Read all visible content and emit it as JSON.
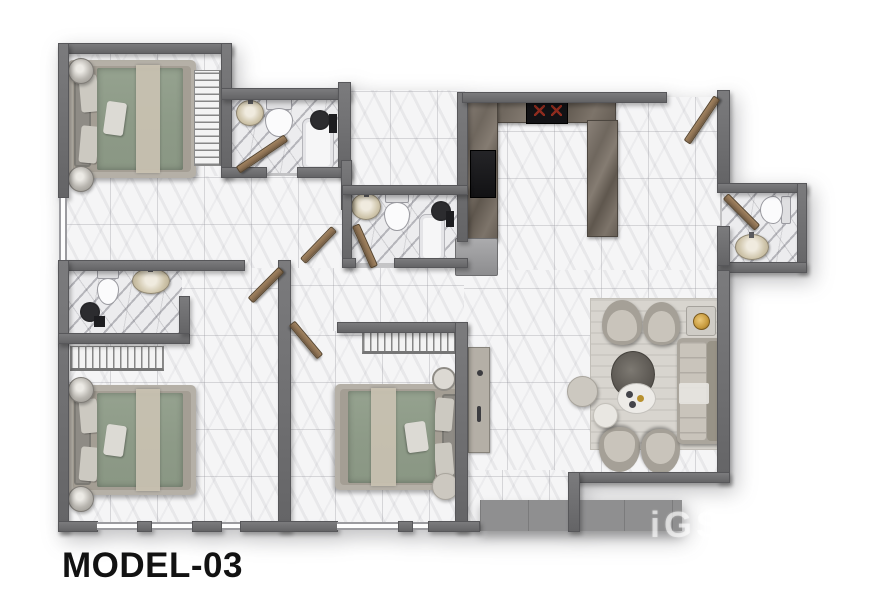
{
  "title": {
    "label": "MODEL-03"
  },
  "watermark": {
    "text": "iGS"
  },
  "colors": {
    "wall": "#6f6f71",
    "wall_dark": "#57575a",
    "floor": "#f5f5f6",
    "duvet": "#8d9a87",
    "frame": "#b5b0a7",
    "upholstery": "#c9c4bb",
    "wood": "#8a6f52",
    "gold": "#c79a3d",
    "slab": "#8f8f90",
    "title": "#121212"
  },
  "plan": {
    "canvas": {
      "w": 890,
      "h": 594
    },
    "floors": [
      {
        "name": "floor-bedroom-1",
        "kind": "fl-tile",
        "rect": [
          63,
          48,
          164,
          130
        ]
      },
      {
        "name": "floor-bathroom-1",
        "kind": "fl-marble",
        "rect": [
          227,
          93,
          116,
          80
        ]
      },
      {
        "name": "floor-entry-hall",
        "kind": "fl-tile",
        "rect": [
          343,
          90,
          122,
          96
        ]
      },
      {
        "name": "floor-kitchen",
        "kind": "fl-tile",
        "rect": [
          460,
          97,
          260,
          176
        ]
      },
      {
        "name": "floor-wc",
        "kind": "fl-marble",
        "rect": [
          722,
          188,
          80,
          79
        ]
      },
      {
        "name": "floor-living",
        "kind": "fl-tile",
        "rect": [
          460,
          270,
          260,
          207
        ]
      },
      {
        "name": "floor-hall",
        "kind": "fl-tile",
        "rect": [
          63,
          176,
          284,
          96
        ]
      },
      {
        "name": "floor-bathroom-2",
        "kind": "fl-marble",
        "rect": [
          347,
          190,
          115,
          73
        ]
      },
      {
        "name": "floor-corridor",
        "kind": "fl-tile",
        "rect": [
          286,
          268,
          178,
          65
        ]
      },
      {
        "name": "floor-bedroom-2",
        "kind": "fl-tile",
        "rect": [
          63,
          268,
          218,
          256
        ]
      },
      {
        "name": "floor-bathroom-3",
        "kind": "fl-marble",
        "rect": [
          67,
          268,
          115,
          68
        ]
      },
      {
        "name": "floor-bedroom-3",
        "kind": "fl-tile",
        "rect": [
          288,
          331,
          170,
          193
        ]
      },
      {
        "name": "floor-corridor-south",
        "kind": "fl-tile",
        "rect": [
          455,
          470,
          115,
          54
        ]
      }
    ],
    "walls": [
      [
        58,
        43,
        174,
        11
      ],
      [
        58,
        43,
        11,
        155
      ],
      [
        221,
        43,
        11,
        135
      ],
      [
        221,
        88,
        130,
        12
      ],
      [
        338,
        82,
        13,
        96
      ],
      [
        221,
        167,
        46,
        11
      ],
      [
        297,
        167,
        54,
        11
      ],
      [
        457,
        92,
        11,
        150
      ],
      [
        462,
        92,
        205,
        11
      ],
      [
        717,
        90,
        13,
        95
      ],
      [
        717,
        183,
        90,
        10
      ],
      [
        797,
        183,
        10,
        89
      ],
      [
        717,
        262,
        90,
        11
      ],
      [
        717,
        226,
        13,
        40
      ],
      [
        717,
        270,
        13,
        213
      ],
      [
        568,
        472,
        162,
        11
      ],
      [
        568,
        472,
        12,
        60
      ],
      [
        341,
        160,
        11,
        50
      ],
      [
        342,
        185,
        10,
        83
      ],
      [
        342,
        185,
        126,
        10
      ],
      [
        342,
        258,
        14,
        10
      ],
      [
        394,
        258,
        74,
        10
      ],
      [
        58,
        260,
        187,
        11
      ],
      [
        58,
        260,
        11,
        272
      ],
      [
        58,
        333,
        132,
        11
      ],
      [
        179,
        296,
        11,
        38
      ],
      [
        278,
        260,
        13,
        272
      ],
      [
        337,
        322,
        131,
        11
      ],
      [
        455,
        322,
        13,
        210
      ],
      [
        58,
        521,
        40,
        11
      ],
      [
        137,
        521,
        15,
        11
      ],
      [
        192,
        521,
        30,
        11
      ],
      [
        240,
        521,
        98,
        11
      ],
      [
        398,
        521,
        15,
        11
      ],
      [
        428,
        521,
        52,
        11
      ]
    ],
    "windows": [
      [
        97,
        522,
        40,
        8
      ],
      [
        152,
        522,
        40,
        8
      ],
      [
        222,
        522,
        18,
        8
      ],
      [
        337,
        522,
        61,
        8
      ],
      [
        413,
        522,
        15,
        8
      ],
      [
        59,
        198,
        8,
        62
      ]
    ],
    "doors": [
      [
        262,
        154,
        58,
        -34
      ],
      [
        702,
        120,
        54,
        -56
      ],
      [
        741,
        212,
        45,
        45
      ],
      [
        318,
        245,
        45,
        -46
      ],
      [
        365,
        246,
        46,
        66
      ],
      [
        266,
        285,
        44,
        -45
      ],
      [
        306,
        340,
        44,
        50
      ]
    ],
    "furniture": [
      {
        "name": "bed-1",
        "type": "bed",
        "rect": [
          68,
          60,
          128,
          118
        ]
      },
      {
        "name": "nightstand-lamp",
        "type": "lamp",
        "rect": [
          68,
          58,
          26,
          26
        ]
      },
      {
        "name": "nightstand-lamp",
        "type": "lamp",
        "rect": [
          68,
          166,
          26,
          26
        ]
      },
      {
        "name": "wardrobe-1",
        "type": "wd wd-v",
        "rect": [
          194,
          70,
          28,
          96
        ]
      },
      {
        "name": "sink-bath-1",
        "type": "sink",
        "rect": [
          236,
          100,
          28,
          26
        ]
      },
      {
        "name": "toilet-bath-1",
        "type": "toilet",
        "rect": [
          262,
          98,
          34,
          40
        ]
      },
      {
        "name": "shower-tray-1",
        "type": "tub",
        "rect": [
          302,
          118,
          32,
          52
        ]
      },
      {
        "name": "shower-head-1",
        "type": "shead",
        "rect": [
          310,
          110,
          20,
          20
        ]
      },
      {
        "name": "shower-mixer-1",
        "type": "sq",
        "rect": [
          329,
          114,
          8,
          19
        ]
      },
      {
        "name": "sink-bath-2",
        "type": "sink",
        "rect": [
          351,
          193,
          30,
          27
        ]
      },
      {
        "name": "toilet-bath-2",
        "type": "toilet",
        "rect": [
          381,
          191,
          32,
          41
        ]
      },
      {
        "name": "shower-tray-2",
        "type": "tub",
        "rect": [
          419,
          214,
          26,
          48
        ]
      },
      {
        "name": "shower-head-2",
        "type": "shead",
        "rect": [
          431,
          201,
          20,
          20
        ]
      },
      {
        "name": "shower-mixer-2",
        "type": "sq",
        "rect": [
          446,
          211,
          8,
          16
        ]
      },
      {
        "name": "kitchen-counter-top",
        "type": "counter",
        "rect": [
          464,
          95,
          152,
          28
        ]
      },
      {
        "name": "cooktop",
        "type": "cook",
        "rect": [
          526,
          95,
          42,
          29
        ]
      },
      {
        "name": "kitchen-counter-left",
        "type": "counter",
        "rect": [
          464,
          95,
          34,
          146
        ]
      },
      {
        "name": "oven",
        "type": "appl",
        "rect": [
          470,
          150,
          26,
          48
        ]
      },
      {
        "name": "kitchen-island",
        "type": "counter",
        "rect": [
          587,
          120,
          31,
          117
        ]
      },
      {
        "name": "fridge",
        "type": "fridge",
        "rect": [
          455,
          238,
          43,
          38
        ]
      },
      {
        "name": "toilet-wc",
        "type": "toilet",
        "rect": [
          757,
          194,
          36,
          32
        ],
        "rot": 90
      },
      {
        "name": "sink-wc",
        "type": "sink",
        "rect": [
          735,
          234,
          34,
          26
        ]
      },
      {
        "name": "living-rug",
        "type": "lrug",
        "rect": [
          590,
          298,
          130,
          152
        ]
      },
      {
        "name": "armchair",
        "type": "chair",
        "rect": [
          602,
          300,
          40,
          45
        ]
      },
      {
        "name": "armchair",
        "type": "chair",
        "rect": [
          643,
          302,
          37,
          43
        ]
      },
      {
        "name": "armchair",
        "type": "chair",
        "rect": [
          599,
          427,
          41,
          45
        ],
        "rot": 180
      },
      {
        "name": "armchair",
        "type": "chair",
        "rect": [
          641,
          429,
          39,
          45
        ],
        "rot": 180
      },
      {
        "name": "sofa",
        "type": "sofa",
        "rect": [
          677,
          338,
          45,
          106
        ]
      },
      {
        "name": "side-table",
        "type": "stable",
        "rect": [
          686,
          306,
          30,
          30
        ]
      },
      {
        "name": "table-lamp-gold",
        "type": "gold",
        "rect": [
          693,
          313,
          17,
          17
        ]
      },
      {
        "name": "coffee-table",
        "type": "tbld",
        "rect": [
          611,
          351,
          44,
          47
        ]
      },
      {
        "name": "tray-table",
        "type": "tblw",
        "rect": [
          617,
          383,
          39,
          31
        ]
      },
      {
        "name": "pouf",
        "type": "pouf",
        "rect": [
          567,
          376,
          31,
          31
        ]
      },
      {
        "name": "pouf-white",
        "type": "poufw",
        "rect": [
          593,
          403,
          25,
          25
        ]
      },
      {
        "name": "bed-2",
        "type": "bed",
        "rect": [
          68,
          385,
          128,
          110
        ]
      },
      {
        "name": "nightstand-lamp",
        "type": "lamp",
        "rect": [
          68,
          377,
          26,
          26
        ]
      },
      {
        "name": "nightstand-lamp",
        "type": "lamp",
        "rect": [
          68,
          486,
          26,
          26
        ]
      },
      {
        "name": "wardrobe-2",
        "type": "wd wd-h",
        "rect": [
          70,
          346,
          94,
          25
        ]
      },
      {
        "name": "toilet-bath-3",
        "type": "toilet",
        "rect": [
          94,
          268,
          28,
          38
        ]
      },
      {
        "name": "sink-bath-3",
        "type": "sink",
        "rect": [
          132,
          268,
          38,
          26
        ]
      },
      {
        "name": "shower-head-3",
        "type": "shead",
        "rect": [
          80,
          302,
          20,
          20
        ]
      },
      {
        "name": "shower-mixer-3",
        "type": "sq",
        "rect": [
          94,
          316,
          11,
          11
        ]
      },
      {
        "name": "bed-3",
        "type": "bed",
        "rect": [
          335,
          384,
          130,
          106
        ],
        "flip": true
      },
      {
        "name": "wardrobe-3",
        "type": "wd wd-h",
        "rect": [
          362,
          328,
          96,
          26
        ]
      },
      {
        "name": "wall-decor-round",
        "type": "decorc",
        "rect": [
          432,
          367,
          24,
          24
        ]
      },
      {
        "name": "pouf",
        "type": "pouf",
        "rect": [
          432,
          473,
          27,
          27
        ]
      },
      {
        "name": "console-desk",
        "type": "desk",
        "rect": [
          468,
          347,
          22,
          106
        ]
      },
      {
        "name": "entrance-slab",
        "type": "slab",
        "rect": [
          480,
          500,
          202,
          31
        ]
      }
    ]
  }
}
